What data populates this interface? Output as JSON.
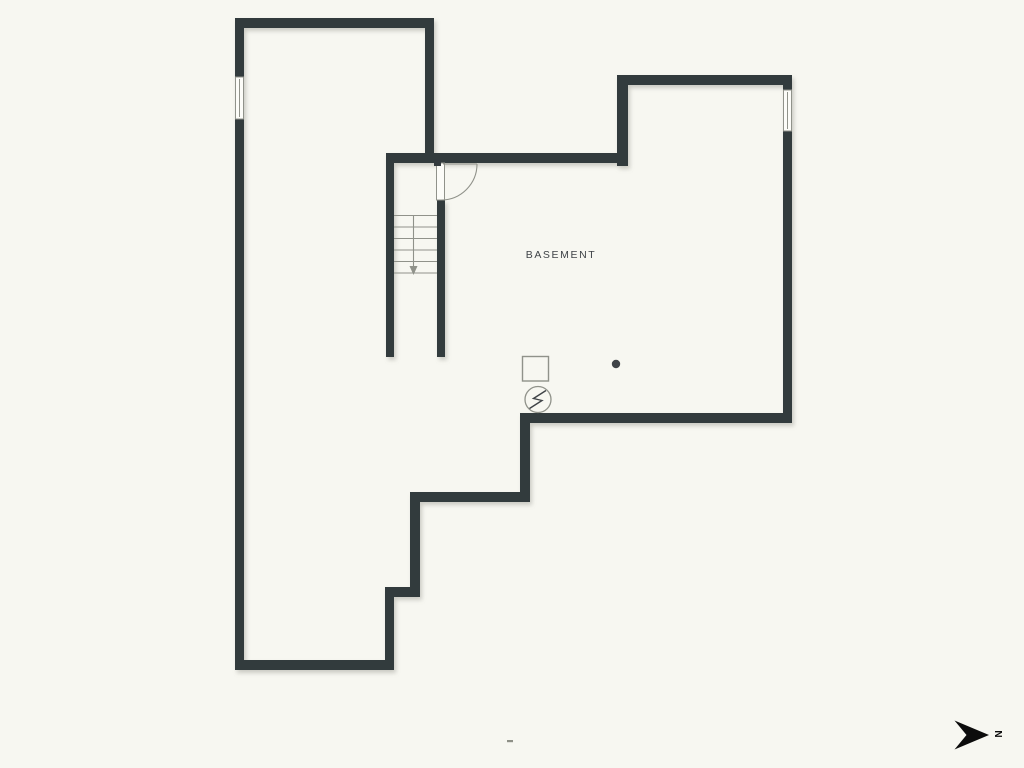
{
  "theme": {
    "background": "#f7f7f1",
    "wall_color": "#333a3e",
    "line_color": "#90928a",
    "label_color": "#3f4347",
    "compass_color": "#0c0c0c"
  },
  "plan": {
    "room_label": "BASEMENT",
    "symbols": [
      {
        "name": "staircase-with-down-arrow"
      },
      {
        "name": "door-swing-arc"
      },
      {
        "name": "window-left-wall"
      },
      {
        "name": "window-right-wall"
      },
      {
        "name": "utility-square-symbol"
      },
      {
        "name": "electrical-panel-symbol"
      },
      {
        "name": "column-dot"
      }
    ]
  },
  "compass": {
    "label": "N"
  }
}
